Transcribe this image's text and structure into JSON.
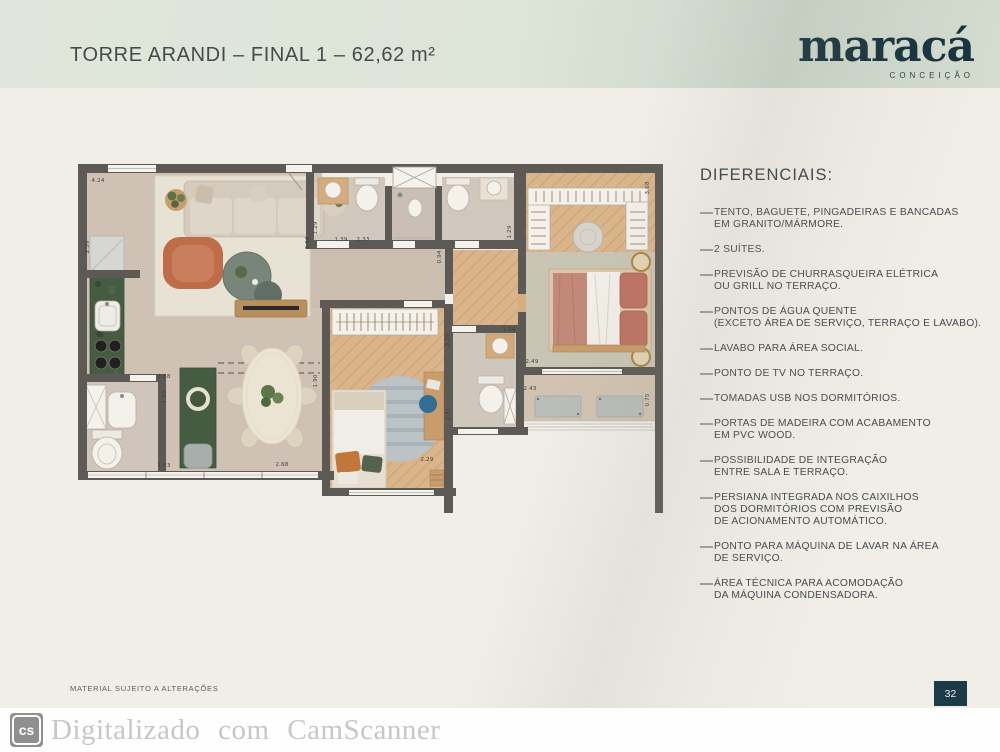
{
  "page": {
    "title": "TORRE ARANDI – FINAL 1 – 62,62 m²",
    "footer_note": "MATERIAL SUJEITO A ALTERAÇÕES",
    "page_number": "32"
  },
  "logo": {
    "name": "maracá",
    "subtitle": "CONCEIÇÃO"
  },
  "features": {
    "heading": "DIFERENCIAIS:",
    "items": [
      {
        "lines": [
          "TENTO, BAGUETE, PINGADEIRAS E BANCADAS",
          "EM GRANITO/MÁRMORE."
        ]
      },
      {
        "lines": [
          "2 SUÍTES."
        ]
      },
      {
        "lines": [
          "PREVISÃO DE CHURRASQUEIRA ELÉTRICA",
          "OU GRILL NO TERRAÇO."
        ]
      },
      {
        "lines": [
          "PONTOS DE ÁGUA QUENTE",
          "(EXCETO ÁREA DE SERVIÇO, TERRAÇO E LAVABO)."
        ]
      },
      {
        "lines": [
          "LAVABO PARA ÁREA SOCIAL."
        ]
      },
      {
        "lines": [
          "PONTO DE TV NO TERRAÇO."
        ]
      },
      {
        "lines": [
          "TOMADAS USB NOS DORMITÓRIOS."
        ]
      },
      {
        "lines": [
          "PORTAS DE MADEIRA COM ACABAMENTO",
          "EM PVC WOOD."
        ]
      },
      {
        "lines": [
          "POSSIBILIDADE DE INTEGRAÇÃO",
          "ENTRE SALA E TERRAÇO."
        ]
      },
      {
        "lines": [
          "PERSIANA INTEGRADA NOS CAIXILHOS",
          "DOS DORMITÓRIOS COM PREVISÃO",
          "DE ACIONAMENTO AUTOMÁTICO."
        ]
      },
      {
        "lines": [
          "PONTO PARA MÁQUINA DE LAVAR NA ÁREA",
          "DE SERVIÇO."
        ]
      },
      {
        "lines": [
          "ÁREA TÉCNICA PARA ACOMODAÇÃO",
          "DA MÁQUINA CONDENSADORA."
        ]
      }
    ]
  },
  "floorplan": {
    "dimension_labels": [
      {
        "text": "4.24",
        "x": 98,
        "y": 182,
        "rot": 0
      },
      {
        "text": "2.59",
        "x": 89,
        "y": 247,
        "rot": -90
      },
      {
        "text": "3.64",
        "x": 309,
        "y": 243,
        "rot": -90
      },
      {
        "text": "1.29",
        "x": 317,
        "y": 228,
        "rot": -90
      },
      {
        "text": "1.39",
        "x": 341,
        "y": 241,
        "rot": 0
      },
      {
        "text": "2.33",
        "x": 363,
        "y": 241,
        "rot": 0
      },
      {
        "text": "1.29",
        "x": 511,
        "y": 232,
        "rot": -90
      },
      {
        "text": "3.68",
        "x": 649,
        "y": 188,
        "rot": -90
      },
      {
        "text": "0.94",
        "x": 441,
        "y": 257,
        "rot": -90
      },
      {
        "text": "1.24",
        "x": 509,
        "y": 331,
        "rot": 0
      },
      {
        "text": "3.29",
        "x": 449,
        "y": 340,
        "rot": -90
      },
      {
        "text": "2.31",
        "x": 450,
        "y": 414,
        "rot": -90
      },
      {
        "text": "1.90",
        "x": 317,
        "y": 381,
        "rot": -90
      },
      {
        "text": "1.58",
        "x": 164,
        "y": 378,
        "rot": 0
      },
      {
        "text": "1.52",
        "x": 166,
        "y": 397,
        "rot": -90
      },
      {
        "text": "1.53",
        "x": 164,
        "y": 467,
        "rot": 0
      },
      {
        "text": "2.68",
        "x": 282,
        "y": 466,
        "rot": 0
      },
      {
        "text": "2.29",
        "x": 427,
        "y": 461,
        "rot": 0
      },
      {
        "text": "2.49",
        "x": 532,
        "y": 363,
        "rot": 0
      },
      {
        "text": "2.43",
        "x": 530,
        "y": 390,
        "rot": 0
      },
      {
        "text": "0.75",
        "x": 649,
        "y": 400,
        "rot": -90
      }
    ]
  },
  "watermark": {
    "icon_label": "cs",
    "text": "Digitalizado com CamScanner"
  },
  "colors": {
    "brand_teal": "#16323e",
    "band_green": "#dde4d8",
    "page_bg": "#f1eee8",
    "badge_teal": "#1c3a47"
  }
}
